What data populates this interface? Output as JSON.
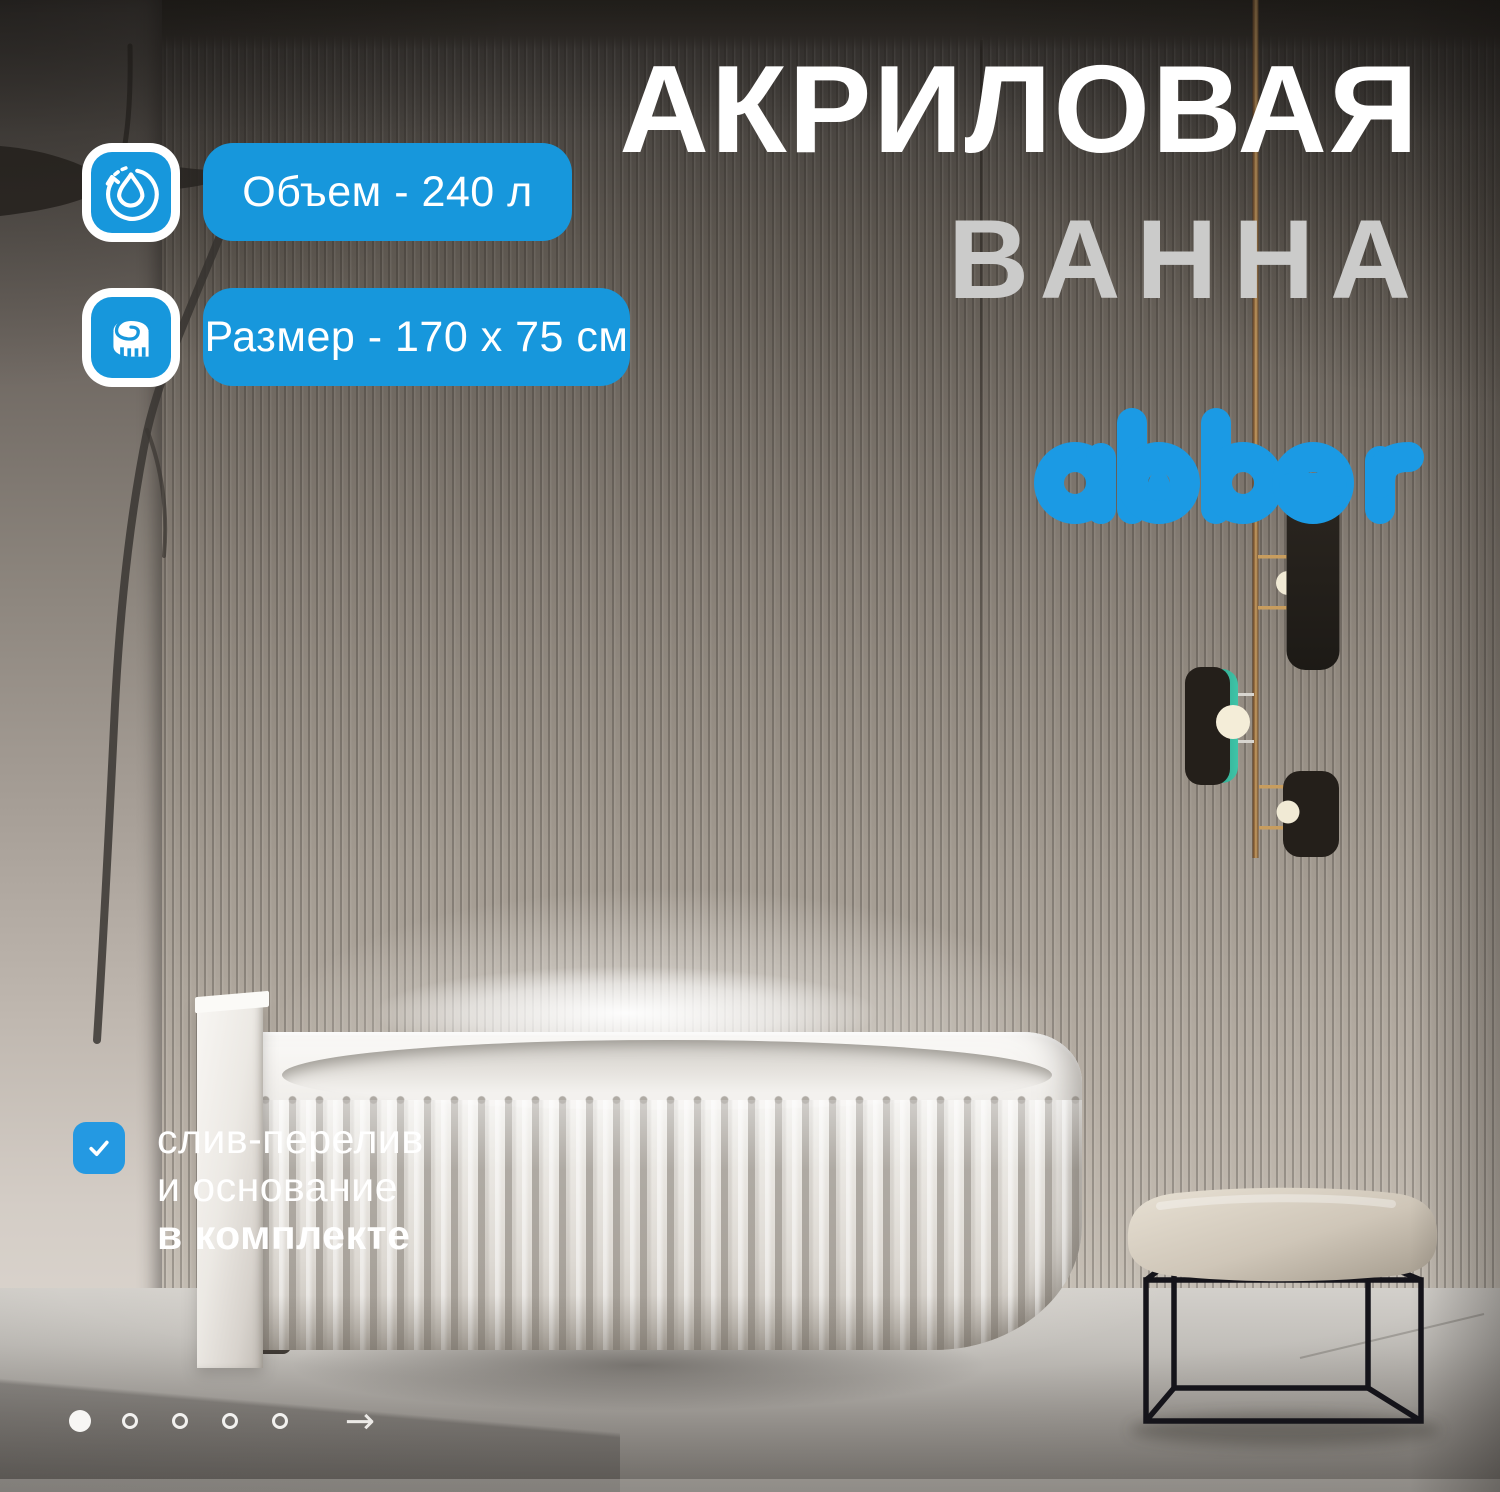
{
  "title": {
    "line1": "АКРИЛОВАЯ",
    "line2": "ВАННА"
  },
  "badges": [
    {
      "icon": "water-volume-icon",
      "label": "Объем - 240 л"
    },
    {
      "icon": "measuring-tape-icon",
      "label": "Размер - 170 х 75 см"
    }
  ],
  "brand": {
    "logo_text": "abber"
  },
  "feature": {
    "icon": "checkmark-icon",
    "line1": "слив-перелив",
    "line2": "и основание",
    "line3": "в комплекте"
  },
  "carousel": {
    "dots": [
      {
        "active": true
      },
      {
        "active": false
      },
      {
        "active": false
      },
      {
        "active": false
      },
      {
        "active": false
      }
    ],
    "next_arrow": "→"
  },
  "colors": {
    "accent": "#1797dc",
    "logo_blue": "#1b9ae4",
    "check_blue": "#2499e2",
    "title_secondary": "#cbcbca"
  }
}
